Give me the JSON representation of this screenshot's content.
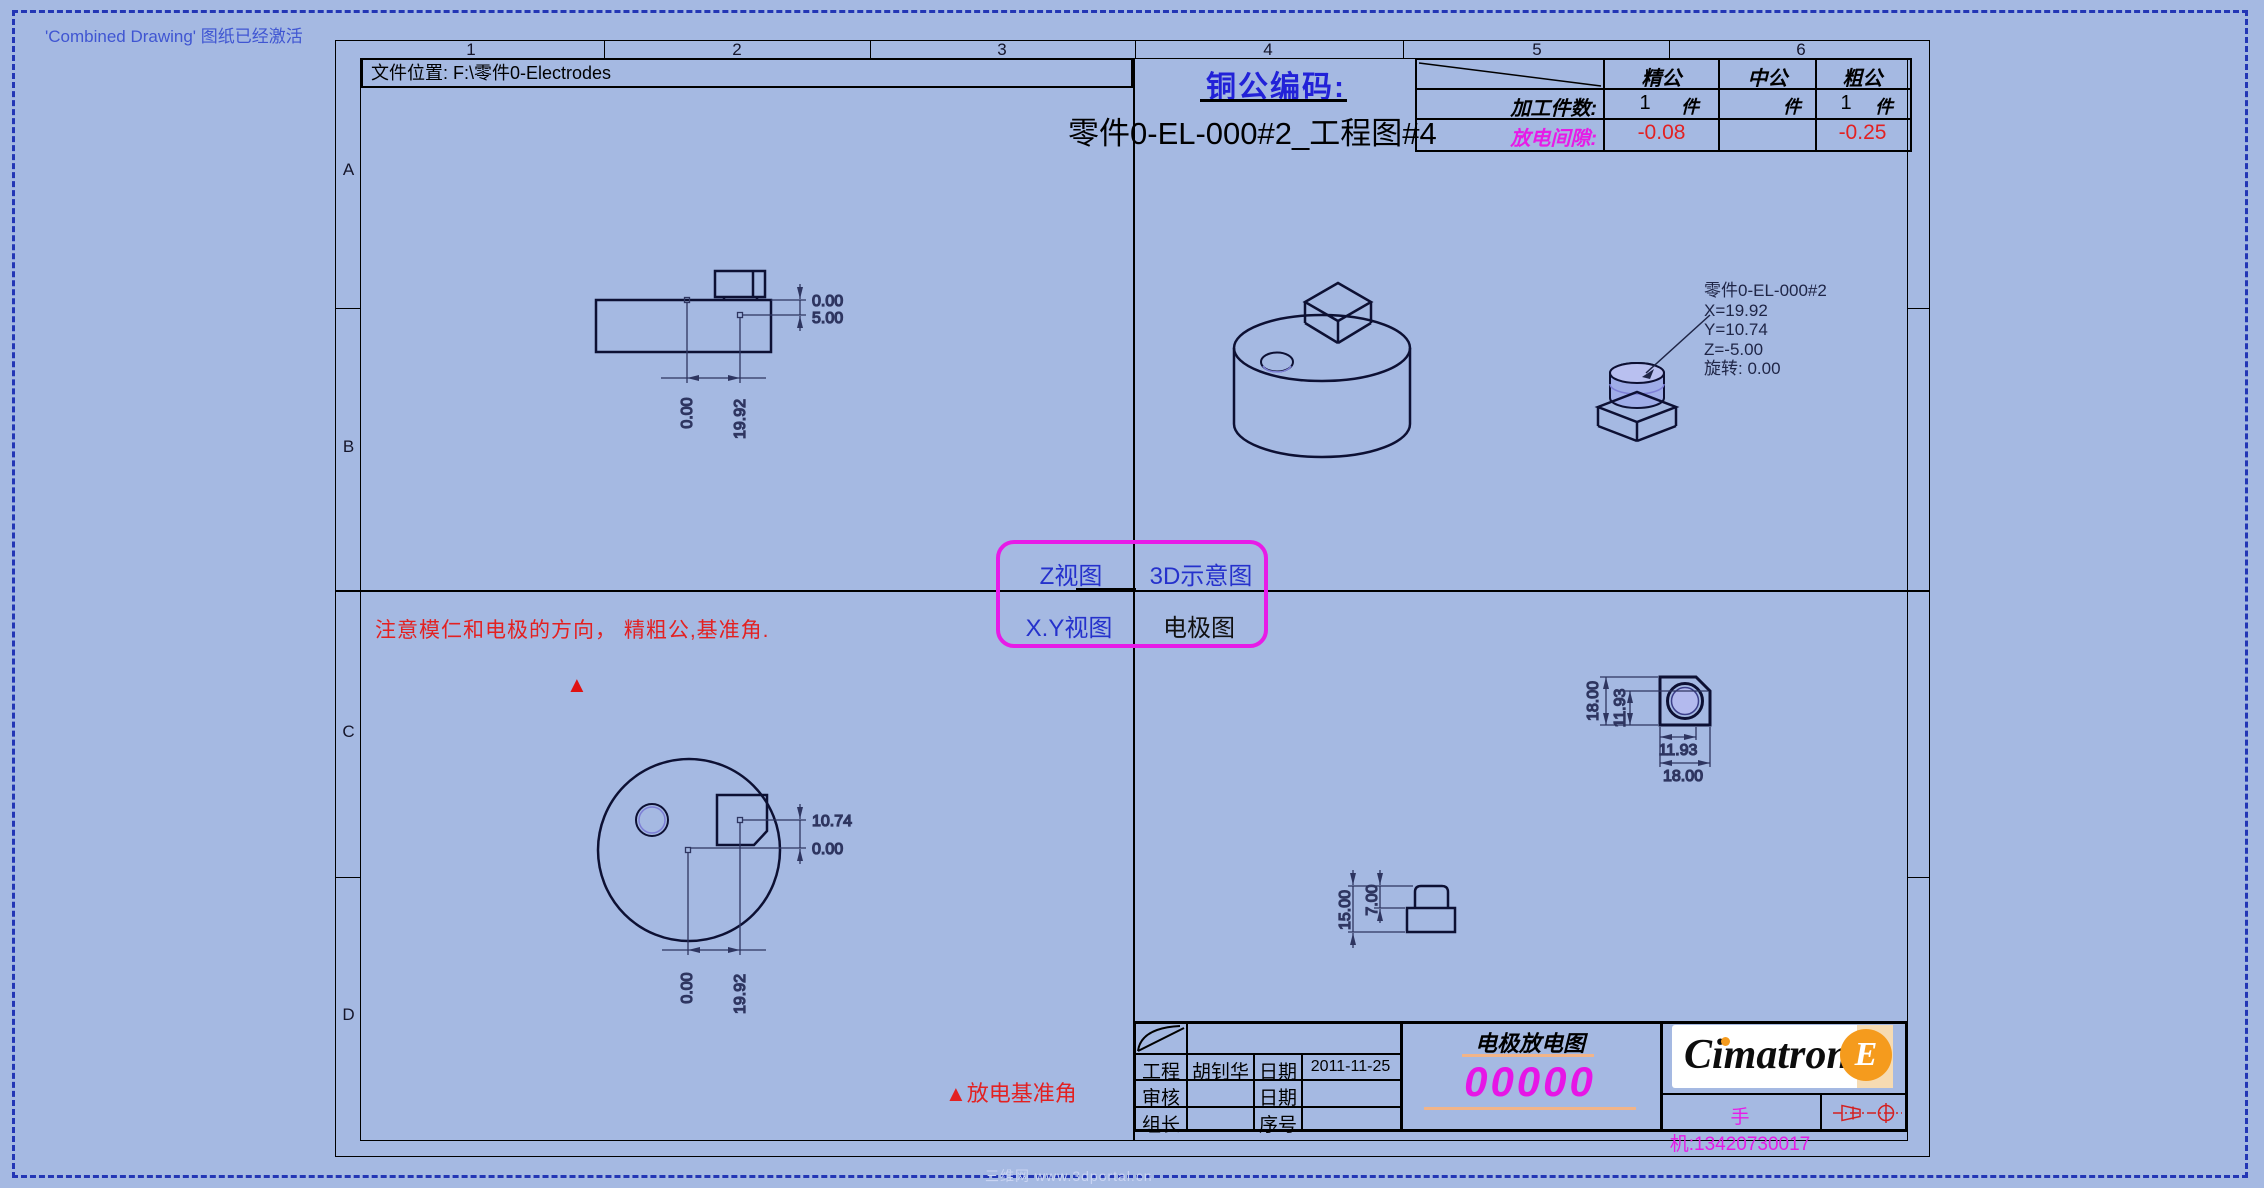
{
  "window": {
    "status_note": "'Combined Drawing' 图纸已经激活"
  },
  "sheet": {
    "file_location": "文件位置: F:\\零件0-Electrodes",
    "grid_columns": [
      "1",
      "2",
      "3",
      "4",
      "5",
      "6"
    ],
    "grid_rows": [
      "A",
      "B",
      "C",
      "D"
    ],
    "electrode_code_label": "铜公编码:",
    "drawing_title": "零件0-EL-000#2_工程图#4"
  },
  "tolerance_table": {
    "headers": [
      "精公",
      "中公",
      "粗公"
    ],
    "qty_label": "加工件数:",
    "qty_unit": "件",
    "quantities": [
      "1",
      "",
      "1"
    ],
    "gap_label": "放电间隙:",
    "gaps": [
      "-0.08",
      "",
      "-0.25"
    ]
  },
  "view_labels": {
    "top_left": "Z视图",
    "top_right": "3D示意图",
    "bottom_left": "X.Y视图",
    "bottom_right": "电极图"
  },
  "notes": {
    "direction_note": "注意模仁和电极的方向， 精粗公,基准角.",
    "triangle_glyph": "▲",
    "datum_note": "放电基准角"
  },
  "part_label": {
    "line1": "零件0-EL-000#2",
    "line2": "X=19.92",
    "line3": "Y=10.74",
    "line4": "Z=-5.00",
    "line5": "旋转: 0.00"
  },
  "dimensions": {
    "z_view": {
      "right_top": "0.00",
      "right_bottom": "5.00",
      "bottom_left": "0.00",
      "bottom_right": "19.92"
    },
    "xy_view": {
      "right_top": "10.74",
      "right_bottom": "0.00",
      "bottom_left": "0.00",
      "bottom_right": "19.92"
    },
    "electrode_front": {
      "left_outer": "18.00",
      "left_inner": "11.93",
      "bottom_inner": "11.93",
      "bottom_outer": "18.00"
    },
    "electrode_side": {
      "total_height": "15.00",
      "boss_height": "7.00"
    }
  },
  "title_block": {
    "rows": [
      {
        "role": "工程",
        "name": "胡钊华",
        "date_label": "日期",
        "value": "2011-11-25"
      },
      {
        "role": "审核",
        "name": "",
        "date_label": "日期",
        "value": ""
      },
      {
        "role": "组长",
        "name": "",
        "date_label": "序号",
        "value": ""
      }
    ],
    "doc_type": "电极放电图",
    "doc_number": "00000",
    "phone": "手机:13420730017",
    "logo": {
      "brand": "Cimatron",
      "edition": "E"
    }
  },
  "watermark": "三维网 www.3dportal.cn",
  "colors": {
    "background": "#a5b9e2",
    "accent_magenta": "#e71be7",
    "warning_red": "#e32121",
    "link_blue": "#2531cc",
    "brand_orange": "#f59b1d"
  }
}
